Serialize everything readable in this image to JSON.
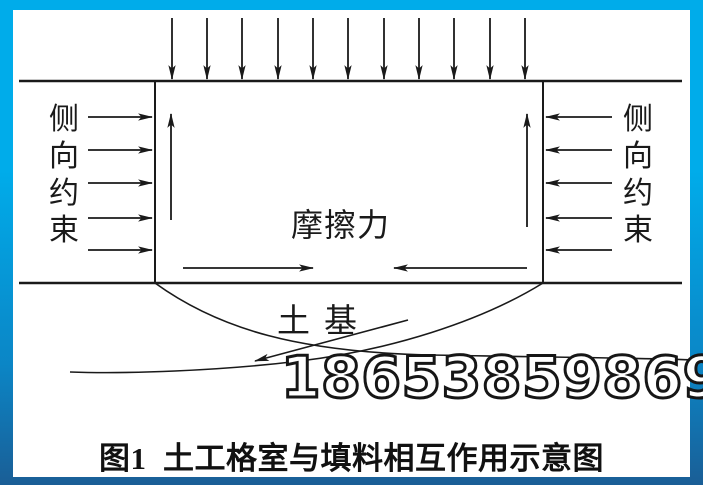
{
  "diagram": {
    "left_constraint_label": "侧向约束",
    "right_constraint_label": "侧向约束",
    "friction_label": "摩擦力",
    "subgrade_label": "土基",
    "watermark_number": "18653859869",
    "caption": "图1  土工格室与填料相互作用示意图",
    "colors": {
      "frame_top": "#00ACEA",
      "frame_bottom": "#1A5E96",
      "line_color": "#1A1A1A",
      "canvas": "#FFFFFF"
    }
  }
}
